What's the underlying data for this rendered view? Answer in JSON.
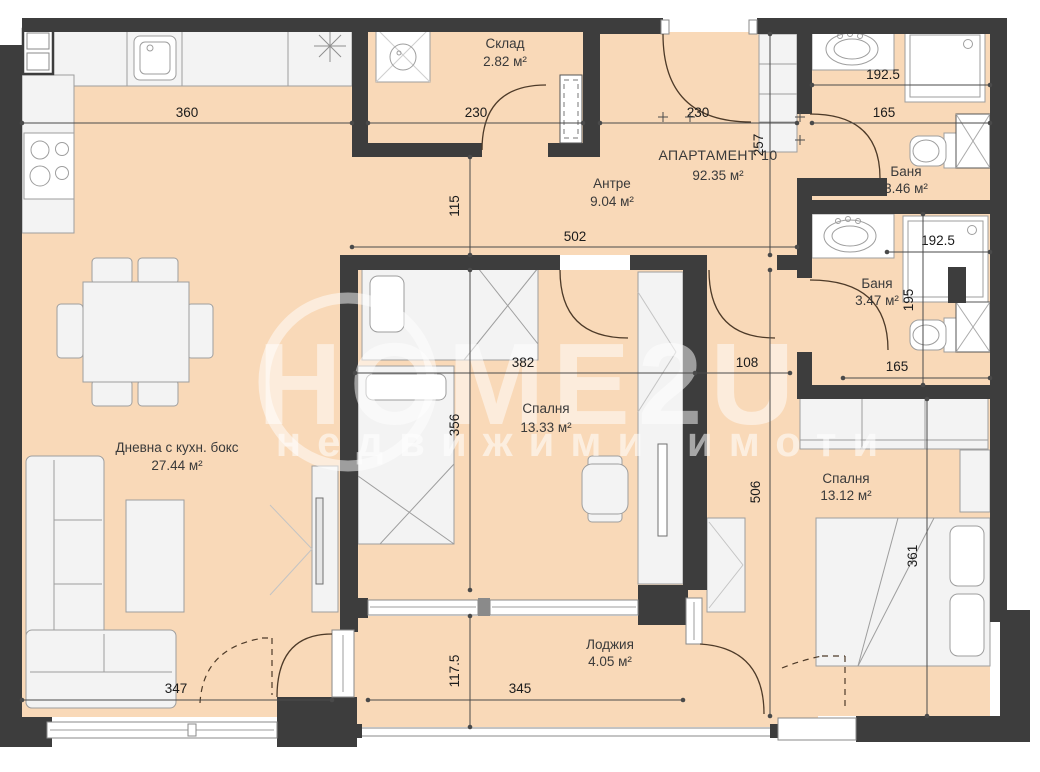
{
  "plan": {
    "title": {
      "name": "АПАРТАМЕНТ 10",
      "area": "92.35 м²"
    },
    "rooms": [
      {
        "name": "Склад",
        "area": "2.82 м²"
      },
      {
        "name": "Антре",
        "area": "9.04 м²"
      },
      {
        "name": "Баня",
        "area": "3.46 м²"
      },
      {
        "name": "Баня",
        "area": "3.47 м²"
      },
      {
        "name": "Спалня",
        "area": "13.33 м²"
      },
      {
        "name": "Спалня",
        "area": "13.12 м²"
      },
      {
        "name": "Дневна с кухн. бокс",
        "area": "27.44 м²"
      },
      {
        "name": "Лоджия",
        "area": "4.05 м²"
      }
    ],
    "dimensions": {
      "top_kitchen": "360",
      "top_storage": "230",
      "top_entry": "230",
      "top_bath": "165",
      "bath1_width": "192.5",
      "entry_height": "257",
      "storage_to_bedroom": "115",
      "hall_width": "502",
      "bath2_width": "192.5",
      "bath2_height": "195",
      "bedroom1_width": "382",
      "corridor_width": "108",
      "bath2_bottom": "165",
      "bedroom1_height": "356",
      "corridor_height": "506",
      "bedroom2_height": "361",
      "living_bottom": "347",
      "loggia_height": "117.5",
      "loggia_width": "345"
    },
    "watermark": {
      "brand": "HOME2U",
      "tagline": "недвижими имоти"
    },
    "colors": {
      "floor": "#f9d9b8",
      "wall": "#3d3d3d",
      "furniture": "#f3f3f3",
      "dimension_text": "#1b1b1b"
    }
  }
}
